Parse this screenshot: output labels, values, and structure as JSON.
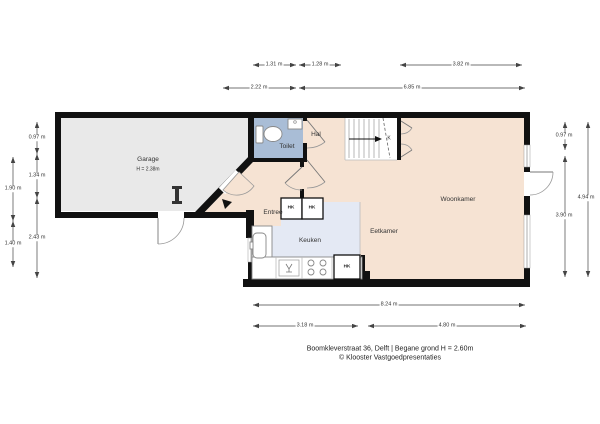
{
  "caption": {
    "line1": "Boomkleverstraat 36, Delft | Begane grond H = 2.60m",
    "line2": "© Klooster Vastgoedpresentaties"
  },
  "rooms": {
    "garage": "Garage",
    "garage_height": "H = 2.38m",
    "toilet": "Toilet",
    "hal": "Hal",
    "entree": "Entree",
    "keuken": "Keuken",
    "eetkamer": "Eetkamer",
    "woonkamer": "Woonkamer",
    "kast": "K",
    "closet1": "HK",
    "closet2": "HK",
    "closet3": "HK"
  },
  "dimensions": {
    "top_row1": [
      "1.31 m",
      "1.28 m",
      "3.82 m"
    ],
    "top_row2": [
      "2.22 m",
      "6.85 m"
    ],
    "bottom_row1": [
      "8.24 m"
    ],
    "bottom_row2": [
      "3.18 m",
      "4.80 m"
    ],
    "left_inner": [
      "0.97 m",
      "1.34 m",
      "2.43 m"
    ],
    "left_outer": [
      "1.90 m",
      "1.40 m"
    ],
    "right_inner": [
      "0.97 m",
      "3.90 m"
    ],
    "right_outer": [
      "4.94 m"
    ]
  },
  "colors": {
    "wall": "#111111",
    "living": "#f6e3d3",
    "toilet_floor": "#a9bdd6",
    "kitchen_floor": "#e4e9f4",
    "garage_floor": "#e9e9e9"
  }
}
